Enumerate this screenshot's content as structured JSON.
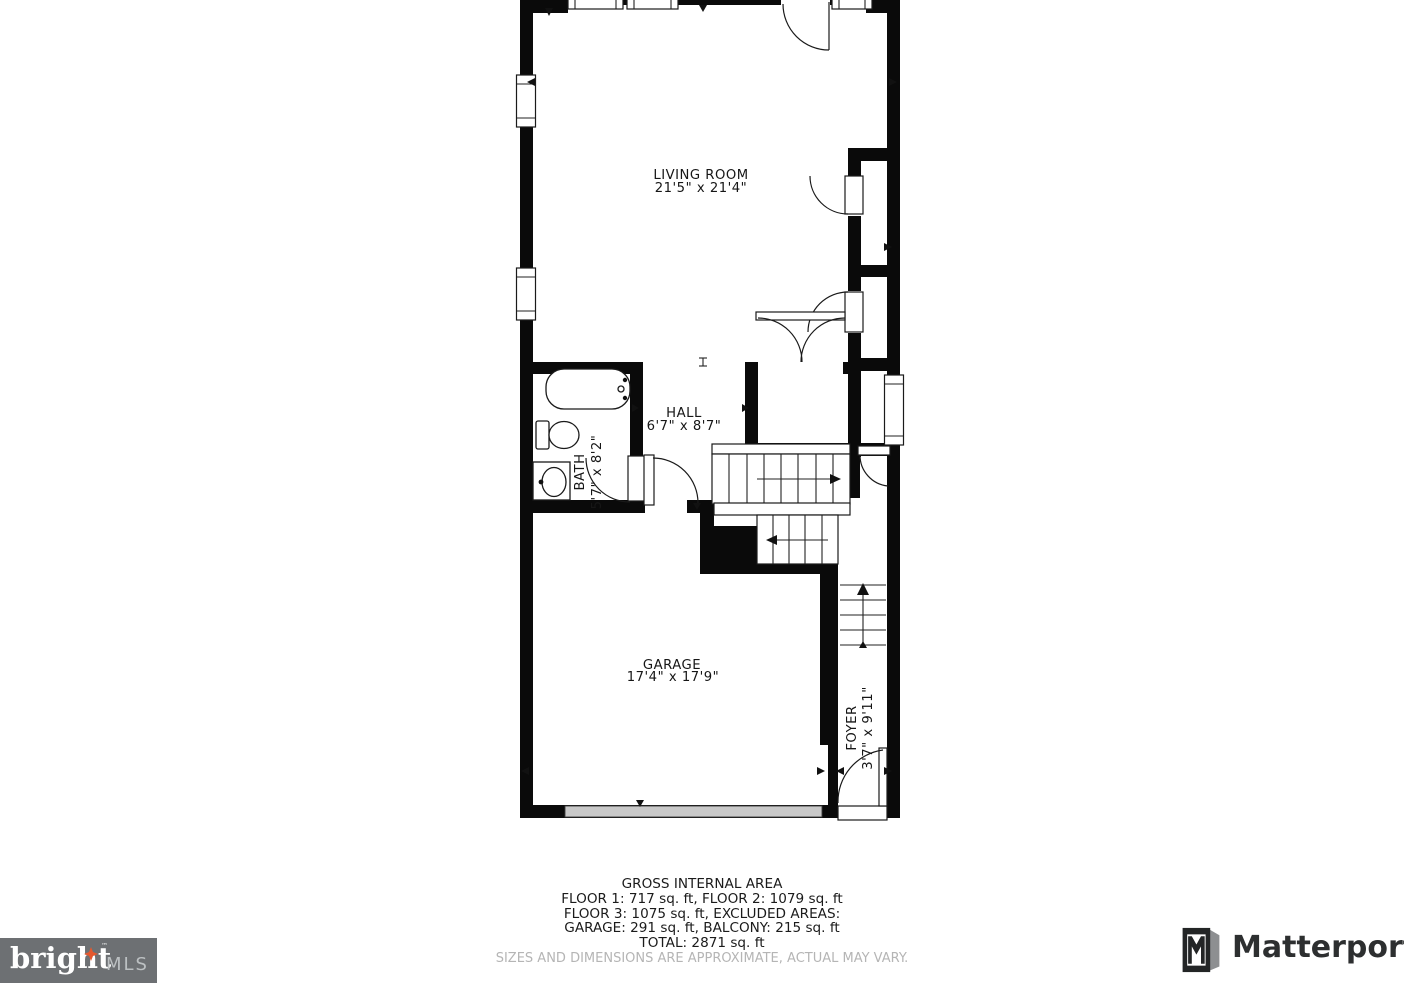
{
  "plan": {
    "rooms": {
      "living_room": {
        "name": "LIVING ROOM",
        "dims": "21'5\" x 21'4\""
      },
      "hall": {
        "name": "HALL",
        "dims": "6'7\" x 8'7\""
      },
      "bath": {
        "name": "BATH",
        "dims": "5'7\" x 8'2\""
      },
      "garage": {
        "name": "GARAGE",
        "dims": "17'4\" x 17'9\""
      },
      "foyer": {
        "name": "FOYER",
        "dims": "3'7\" x 9'11\""
      }
    }
  },
  "area_summary": {
    "title": "GROSS INTERNAL AREA",
    "line1": "FLOOR 1: 717 sq. ft, FLOOR 2: 1079 sq. ft",
    "line2": "FLOOR 3: 1075 sq. ft, EXCLUDED AREAS:",
    "line3": "GARAGE: 291 sq. ft, BALCONY: 215 sq. ft",
    "line4": "TOTAL: 2871 sq. ft",
    "disclaimer": "SIZES AND DIMENSIONS ARE APPROXIMATE, ACTUAL MAY VARY."
  },
  "branding": {
    "bright": {
      "word": "bright",
      "tm": "™",
      "suffix": "MLS"
    },
    "matterport": {
      "label": "Matterport"
    }
  },
  "colors": {
    "wall": "#0a0a0a",
    "accent_orange": "#e4582e",
    "bright_box_gray": "#6d7073",
    "mls_text_gray": "#bcc0c2",
    "matterport_dark": "#2d2f30",
    "garage_door_gray": "#c8c8c8",
    "disclaimer_gray": "#b5b5b5"
  }
}
